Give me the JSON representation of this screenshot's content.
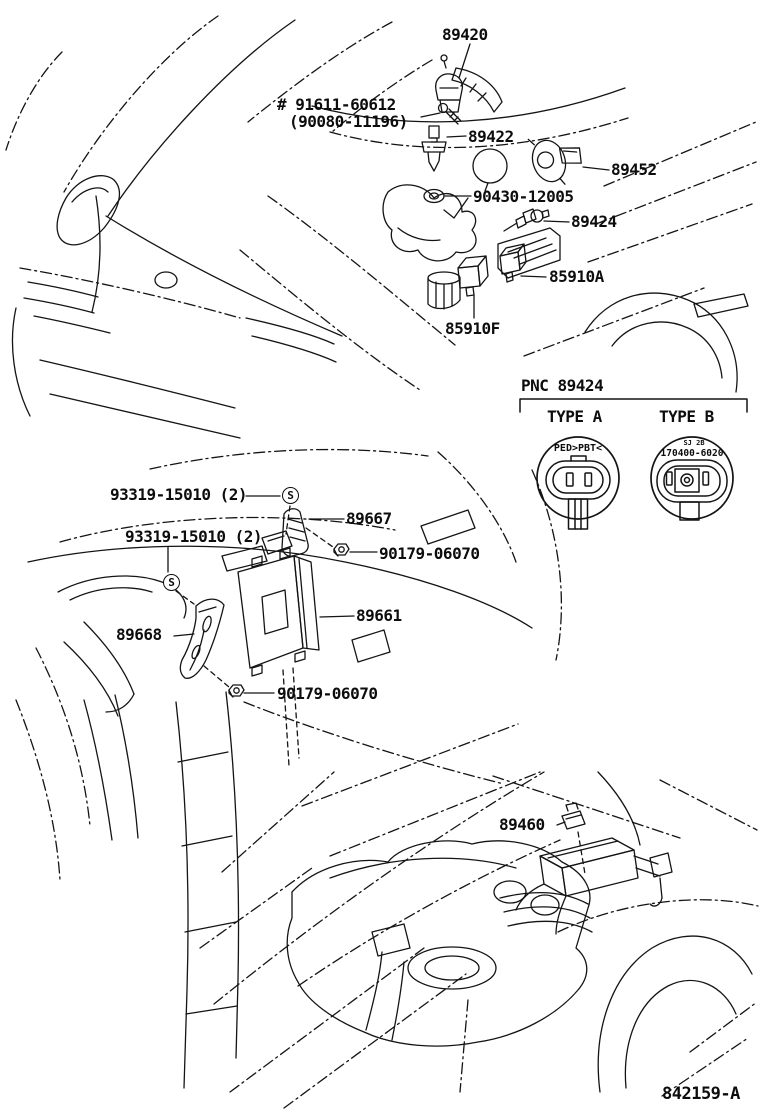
{
  "labels": {
    "p89420": "89420",
    "bolt_note_1": "# 91611-60612",
    "bolt_note_2": "(90080-11196)",
    "p89422": "89422",
    "p89452": "89452",
    "p90430": "90430-12005",
    "p89424": "89424",
    "p85910a": "85910A",
    "p85910f": "85910F",
    "screw_label": "93319-15010 (2)",
    "p89667": "89667",
    "nut_label": "90179-06070",
    "p89661": "89661",
    "p89668": "89668",
    "p89460": "89460"
  },
  "pnc_panel": {
    "title": "PNC 89424",
    "type_a_label": "TYPE A",
    "type_b_label": "TYPE B",
    "type_a_marking": "PED>PBT<",
    "type_b_marking_small": "SJ 2B",
    "type_b_marking": "170400-6020"
  },
  "symbols": {
    "screw": "S"
  },
  "footer": {
    "drawing_code": "842159-A"
  }
}
